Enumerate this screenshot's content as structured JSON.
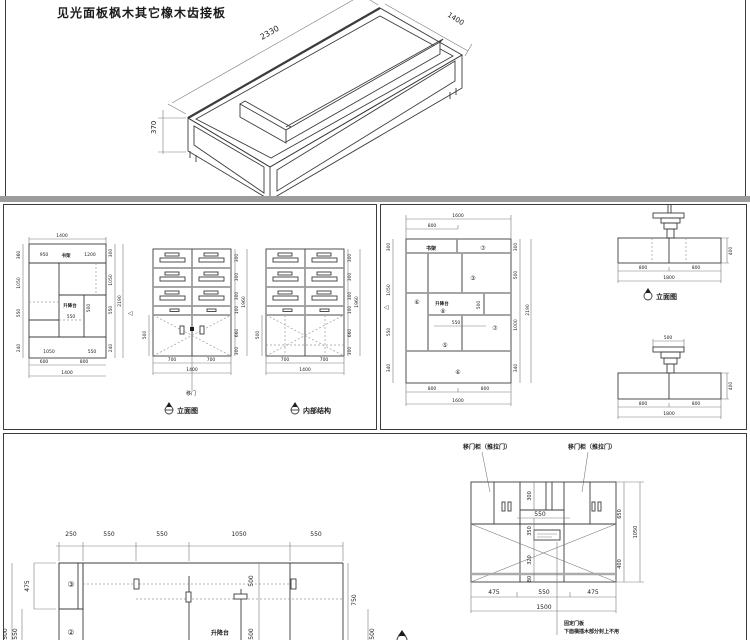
{
  "colors": {
    "line": "#3c3c3c",
    "gray": "#9a9a9a",
    "divider": "#9c9c9c"
  },
  "top_panel": {
    "title": "见光面板枫木其它橡木齿接板",
    "iso": {
      "length": "2330",
      "width": "1400",
      "height": "370"
    }
  },
  "mid_left": {
    "plan": {
      "dim_top": "1400",
      "strip": {
        "left": "950",
        "label": "书架",
        "right": "1200"
      },
      "lift_label": "升降台",
      "dim_500": "500",
      "dim_550": "550",
      "inner_bottom": [
        "1050",
        "550"
      ],
      "left_dims": [
        "360",
        "1050",
        "550",
        "240"
      ],
      "right_dims": [
        "300",
        "1050",
        "550",
        "240"
      ],
      "right_total": "2190",
      "bottom_split": [
        "600",
        "800"
      ],
      "dim_bottom": "1400",
      "section_marker": "◁"
    },
    "elevation": {
      "caption": "立面图",
      "door_label": "移门",
      "right_dims": [
        "300",
        "300",
        "300",
        "100",
        "660",
        "300"
      ],
      "right_total": "1960",
      "left_dim": "500",
      "bottom_split": [
        "700",
        "700"
      ],
      "dim_bottom": "1400"
    },
    "structure": {
      "caption": "内部结构",
      "right_dims": [
        "300",
        "300",
        "300",
        "100",
        "660",
        "300"
      ],
      "right_total": "1960",
      "left_dim": "500",
      "bottom_split": [
        "700",
        "700"
      ],
      "dim_bottom": "1400"
    }
  },
  "mid_right": {
    "plan": {
      "dim_top_total": "1600",
      "dim_top_half": "800",
      "shelf_label": "书架",
      "lift_label": "升降台",
      "dim_v": "500",
      "dim_h": "550",
      "markers": {
        "top_right": "⑦",
        "mid": "③",
        "left": "⑥",
        "lift": "⑧",
        "low_left": "⑤",
        "right": "⑦",
        "bottom": "⑥"
      },
      "left_dims": [
        "300",
        "1050",
        "550",
        "340"
      ],
      "right_dims": [
        "300",
        "500",
        "1000",
        "340"
      ],
      "right_total": "2190",
      "bottom_split": [
        "800",
        "800"
      ],
      "dim_bottom": "1600",
      "section_marker": "◁"
    },
    "elev_top": {
      "caption": "立面图",
      "bottom_split": [
        "800",
        "800"
      ],
      "dim_bottom": "1800",
      "dim_height": "400"
    },
    "elev_bottom": {
      "dim_top": "500",
      "bottom_split": [
        "800",
        "800"
      ],
      "dim_bottom": "1800",
      "dim_height": "400"
    }
  },
  "bottom_panel": {
    "plan": {
      "top_dims": [
        "250",
        "550",
        "550",
        "1050",
        "550"
      ],
      "left_dims": {
        "d475": "475",
        "d550": "550",
        "d500": "500"
      },
      "markers": {
        "m3": "③",
        "m2": "②"
      },
      "lift_label": "升降台",
      "dim_v_top": "500",
      "dim_v_bottom": "500",
      "right_dims": {
        "d750": "750",
        "d500": "500"
      }
    },
    "cabinet": {
      "label_left": "移门柜（推拉门）",
      "label_right": "移门柜（推拉门）",
      "center_dims": {
        "d300": "300",
        "d550": "550",
        "d350": "350",
        "d320": "320",
        "d80": "80"
      },
      "right_dims": {
        "d650": "650",
        "d1050": "1050",
        "d400": "400"
      },
      "bottom_dims": [
        "475",
        "550",
        "475"
      ],
      "bottom_total": "1500",
      "notes": [
        "固定门板",
        "下面横插木部分封上不用"
      ]
    }
  }
}
